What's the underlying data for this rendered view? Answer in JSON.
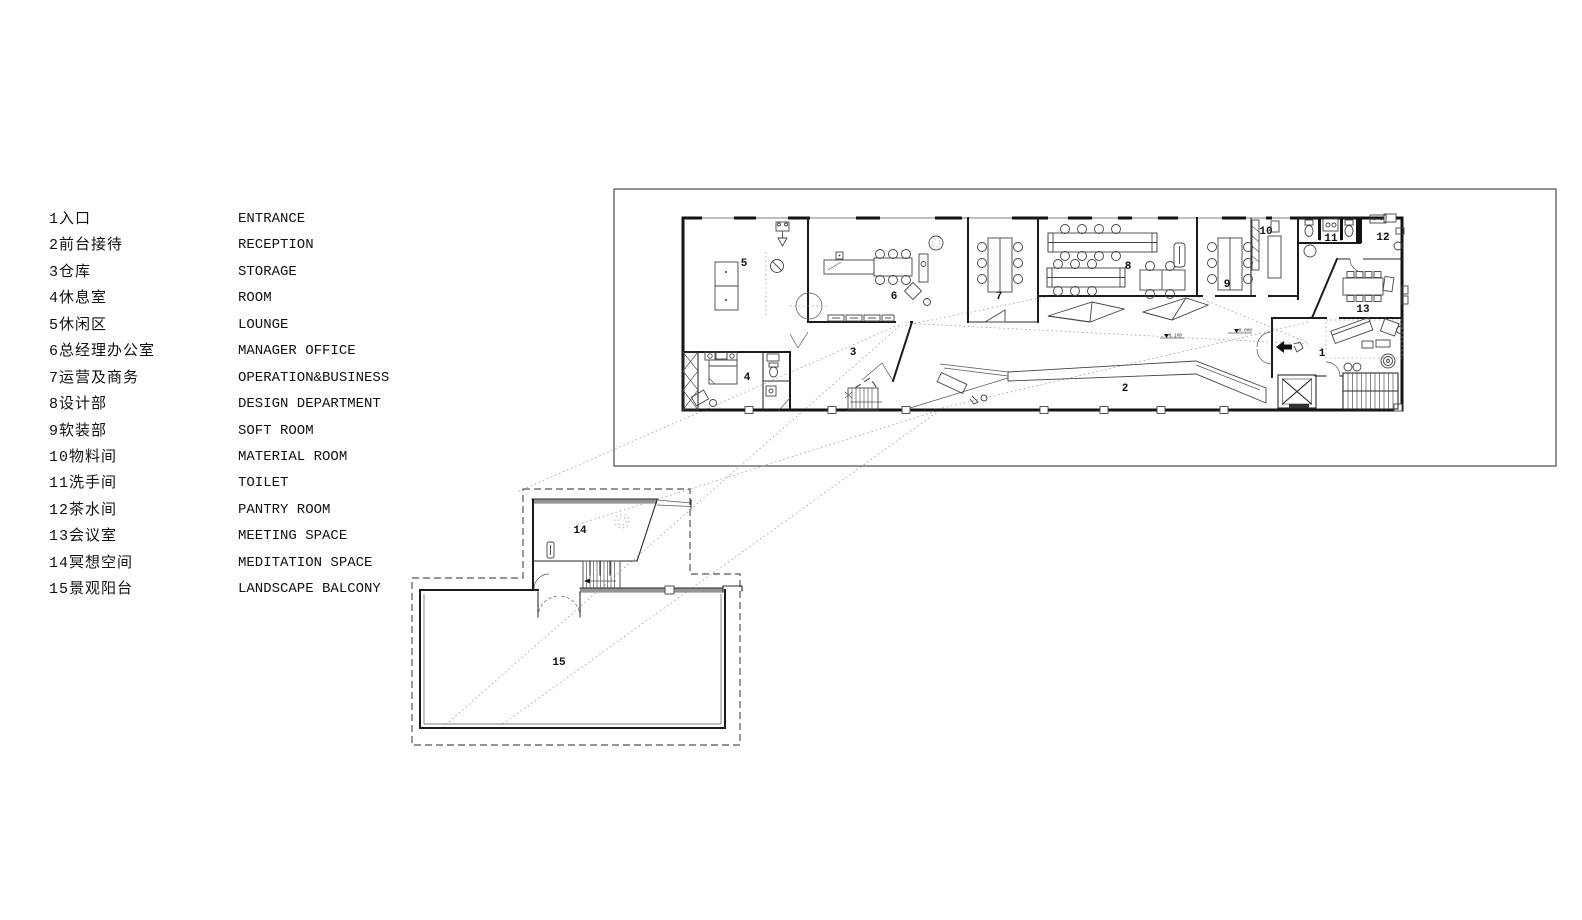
{
  "legend": {
    "items": [
      {
        "no": "1",
        "zh": "入口",
        "en": "ENTRANCE"
      },
      {
        "no": "2",
        "zh": "前台接待",
        "en": "RECEPTION"
      },
      {
        "no": "3",
        "zh": "仓库",
        "en": "STORAGE"
      },
      {
        "no": "4",
        "zh": "休息室",
        "en": "ROOM"
      },
      {
        "no": "5",
        "zh": "休闲区",
        "en": "LOUNGE"
      },
      {
        "no": "6",
        "zh": "总经理办公室",
        "en": "MANAGER OFFICE"
      },
      {
        "no": "7",
        "zh": "运营及商务",
        "en": "OPERATION&BUSINESS"
      },
      {
        "no": "8",
        "zh": "设计部",
        "en": "DESIGN DEPARTMENT"
      },
      {
        "no": "9",
        "zh": "软装部",
        "en": "SOFT ROOM"
      },
      {
        "no": "10",
        "zh": "物料间",
        "en": "MATERIAL ROOM"
      },
      {
        "no": "11",
        "zh": "洗手间",
        "en": "TOILET"
      },
      {
        "no": "12",
        "zh": "茶水间",
        "en": "PANTRY ROOM"
      },
      {
        "no": "13",
        "zh": "会议室",
        "en": "MEETING SPACE"
      },
      {
        "no": "14",
        "zh": "冥想空间",
        "en": "MEDITATION SPACE"
      },
      {
        "no": "15",
        "zh": "景观阳台",
        "en": "LANDSCAPE BALCONY"
      }
    ]
  },
  "plan": {
    "room_labels": {
      "r1": "1",
      "r2": "2",
      "r3": "3",
      "r4": "4",
      "r5": "5",
      "r6": "6",
      "r7": "7",
      "r8": "8",
      "r9": "9",
      "r10": "10",
      "r11": "11",
      "r12": "12",
      "r13": "13",
      "r14": "14",
      "r15": "15"
    },
    "level_markers": {
      "low": "-0.100",
      "zero": "±0.000"
    }
  },
  "colors": {
    "line": "#1b1b1b",
    "light_line": "#979797",
    "wall_gray": "#949494"
  }
}
